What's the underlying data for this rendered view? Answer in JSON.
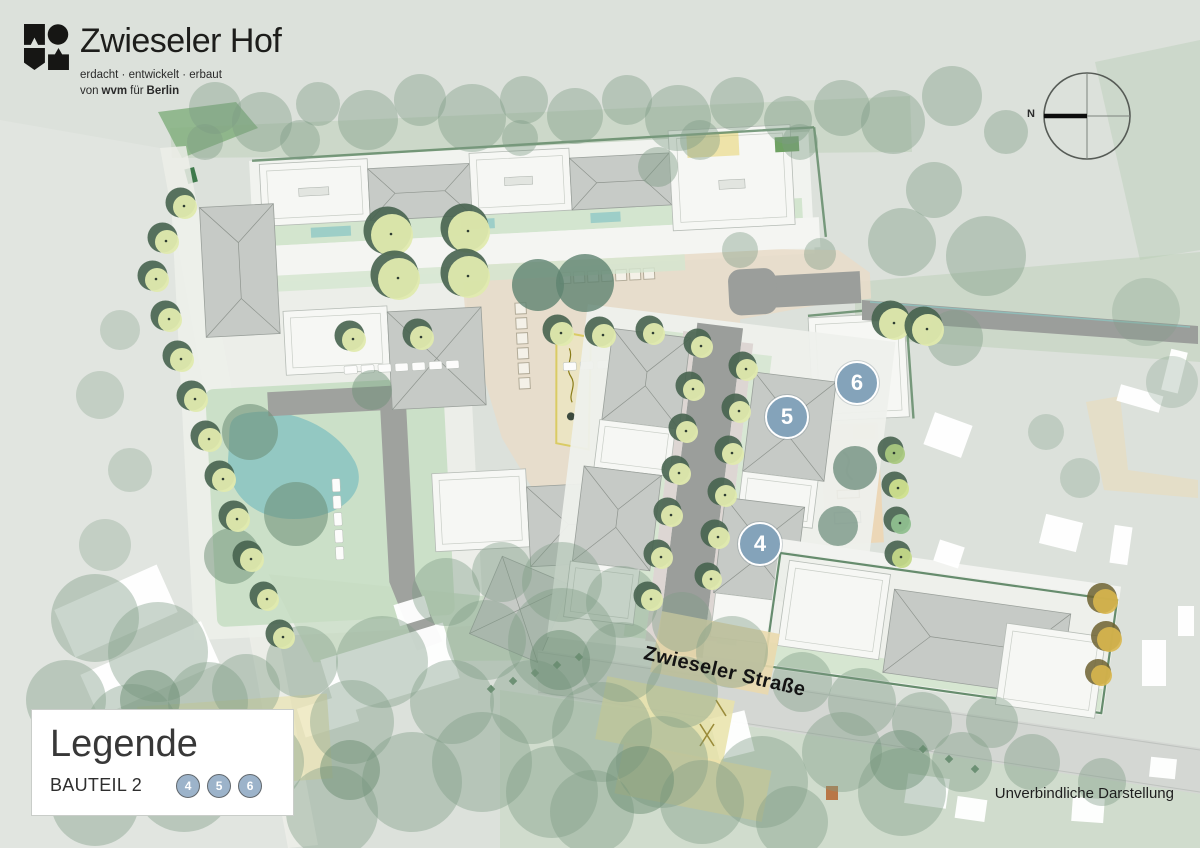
{
  "brand": {
    "title": "Zwieseler Hof",
    "tagline": "erdacht · entwickelt · erbaut",
    "byline": {
      "pre": "von",
      "wvm": "wvm",
      "fuer": "für",
      "city": "Berlin"
    }
  },
  "compass": {
    "north_label": "N"
  },
  "map": {
    "street_label": "Zwieseler Straße",
    "markers": [
      {
        "label": "4"
      },
      {
        "label": "5"
      },
      {
        "label": "6"
      }
    ]
  },
  "legend": {
    "title": "Legende",
    "section_label": "BAUTEIL 2",
    "items": [
      "4",
      "5",
      "6"
    ]
  },
  "footer": {
    "disclaimer": "Unverbindliche Darstellung"
  },
  "colors": {
    "marker_blue": "#84a3ba",
    "legend_circle_blue": "#9cb3ca",
    "brand_black": "#1d1d1b"
  }
}
